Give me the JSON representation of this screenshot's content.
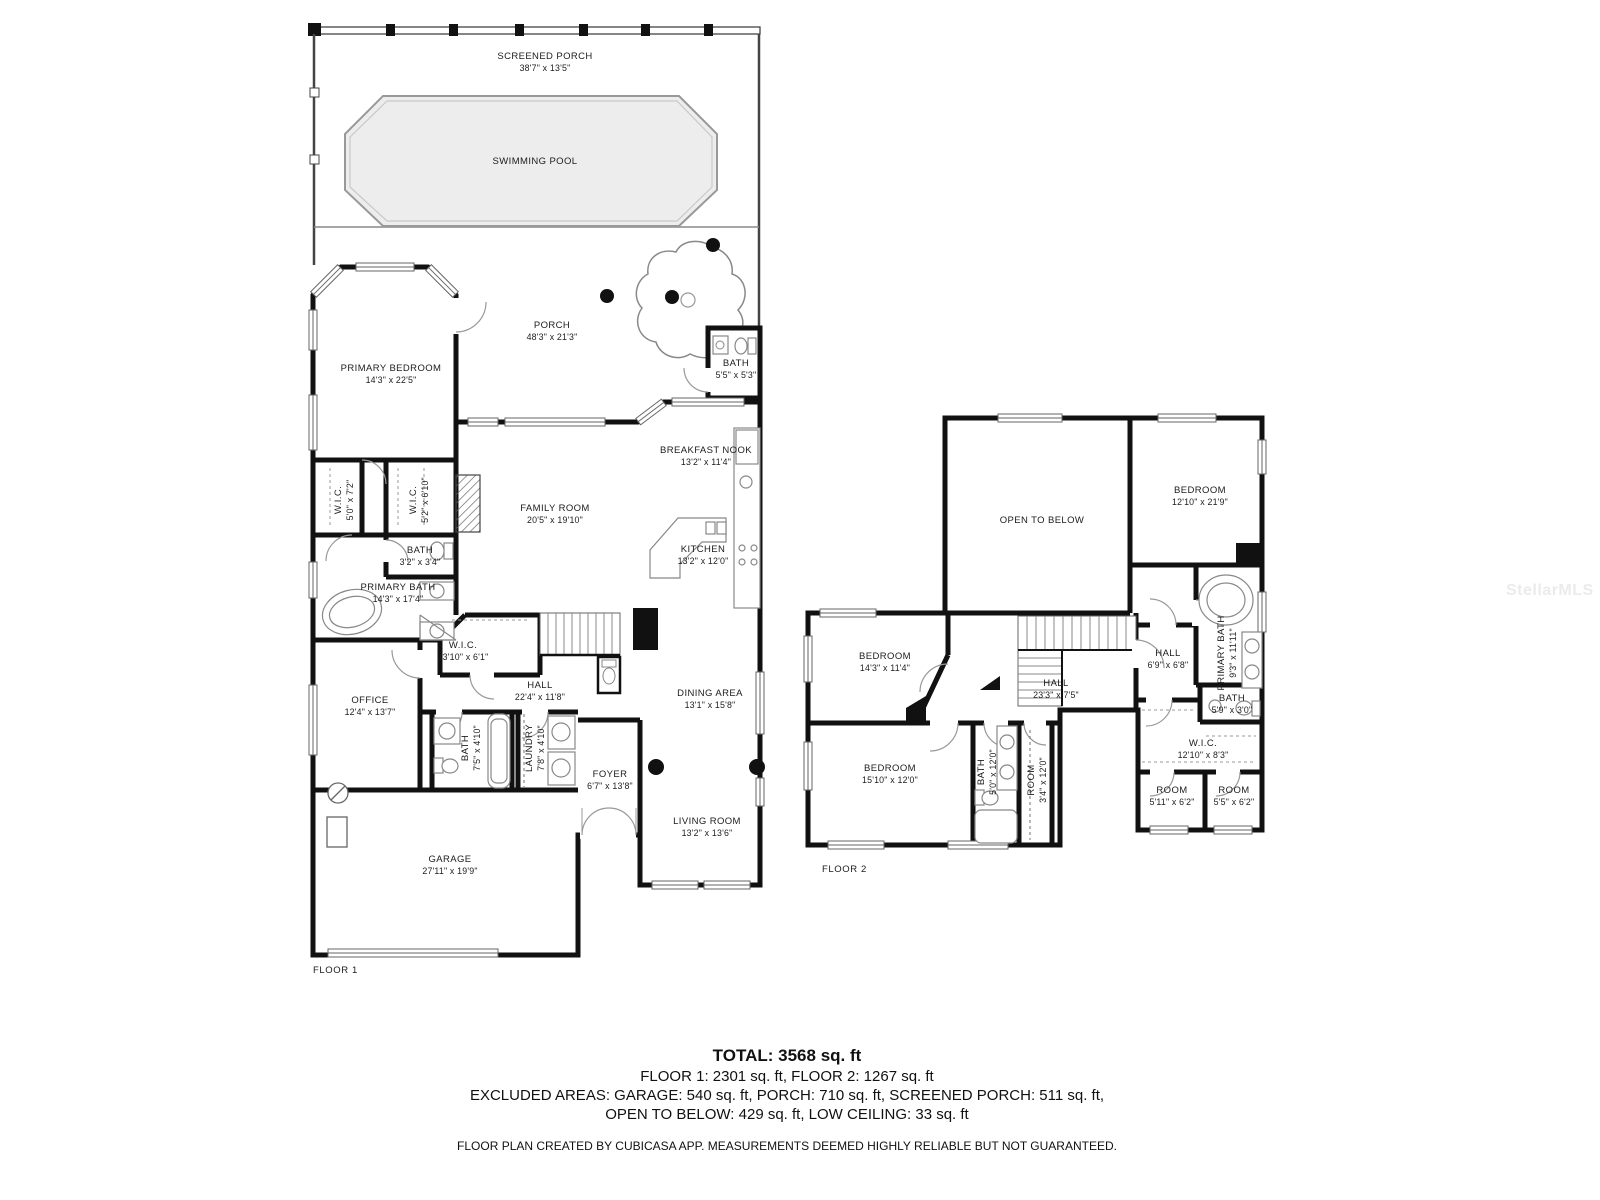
{
  "watermark": "StellarMLS",
  "colors": {
    "wall": "#111111",
    "pool_fill": "#ededed"
  },
  "floor1": {
    "label": "FLOOR 1",
    "rooms": [
      {
        "name": "SCREENED PORCH",
        "dims": "38'7\" x 13'5\""
      },
      {
        "name": "SWIMMING POOL",
        "dims": ""
      },
      {
        "name": "PORCH",
        "dims": "48'3\" x 21'3\""
      },
      {
        "name": "PRIMARY BEDROOM",
        "dims": "14'3\" x 22'5\""
      },
      {
        "name": "BATH",
        "dims": "5'5\" x 5'3\""
      },
      {
        "name": "BREAKFAST NOOK",
        "dims": "13'2\" x 11'4\""
      },
      {
        "name": "FAMILY ROOM",
        "dims": "20'5\" x 19'10\""
      },
      {
        "name": "KITCHEN",
        "dims": "13'2\" x 12'0\""
      },
      {
        "name": "W.I.C.",
        "dims": "5'0\" x 7'2\""
      },
      {
        "name": "W.I.C.",
        "dims": "5'2\" x 6'10\""
      },
      {
        "name": "BATH",
        "dims": "3'2\" x 3'4\""
      },
      {
        "name": "PRIMARY BATH",
        "dims": "14'3\" x 17'4\""
      },
      {
        "name": "W.I.C.",
        "dims": "13'10\" x 6'1\""
      },
      {
        "name": "OFFICE",
        "dims": "12'4\" x 13'7\""
      },
      {
        "name": "HALL",
        "dims": "22'4\" x 11'8\""
      },
      {
        "name": "BATH",
        "dims": "7'5\" x 4'10\""
      },
      {
        "name": "LAUNDRY",
        "dims": "7'8\" x 4'10\""
      },
      {
        "name": "DINING AREA",
        "dims": "13'1\" x 15'8\""
      },
      {
        "name": "FOYER",
        "dims": "6'7\" x 13'8\""
      },
      {
        "name": "LIVING ROOM",
        "dims": "13'2\" x 13'6\""
      },
      {
        "name": "GARAGE",
        "dims": "27'11\" x 19'9\""
      }
    ]
  },
  "floor2": {
    "label": "FLOOR 2",
    "rooms": [
      {
        "name": "OPEN TO BELOW",
        "dims": ""
      },
      {
        "name": "BEDROOM",
        "dims": "12'10\" x 21'9\""
      },
      {
        "name": "BEDROOM",
        "dims": "14'3\" x 11'4\""
      },
      {
        "name": "HALL",
        "dims": "23'3\" x 7'5\""
      },
      {
        "name": "BEDROOM",
        "dims": "15'10\" x 12'0\""
      },
      {
        "name": "BATH",
        "dims": "5'0\" x 12'0\""
      },
      {
        "name": "ROOM",
        "dims": "3'4\" x 12'0\""
      },
      {
        "name": "HALL",
        "dims": "6'9\" x 6'8\""
      },
      {
        "name": "PRIMARY BATH",
        "dims": "9'3\" x 11'11\""
      },
      {
        "name": "BATH",
        "dims": "5'9\" x 3'0\""
      },
      {
        "name": "W.I.C.",
        "dims": "12'10\" x 8'3\""
      },
      {
        "name": "ROOM",
        "dims": "5'11\" x 6'2\""
      },
      {
        "name": "ROOM",
        "dims": "5'5\" x 6'2\""
      }
    ]
  },
  "footer": {
    "total": "TOTAL: 3568 sq. ft",
    "floors": "FLOOR 1: 2301 sq. ft, FLOOR 2: 1267 sq. ft",
    "excluded1": "EXCLUDED AREAS: GARAGE: 540 sq. ft, PORCH: 710 sq. ft, SCREENED PORCH: 511 sq. ft,",
    "excluded2": "OPEN TO BELOW: 429 sq. ft, LOW CEILING: 33 sq. ft",
    "disclaimer": "FLOOR PLAN CREATED BY CUBICASA APP. MEASUREMENTS DEEMED HIGHLY RELIABLE BUT NOT GUARANTEED."
  }
}
